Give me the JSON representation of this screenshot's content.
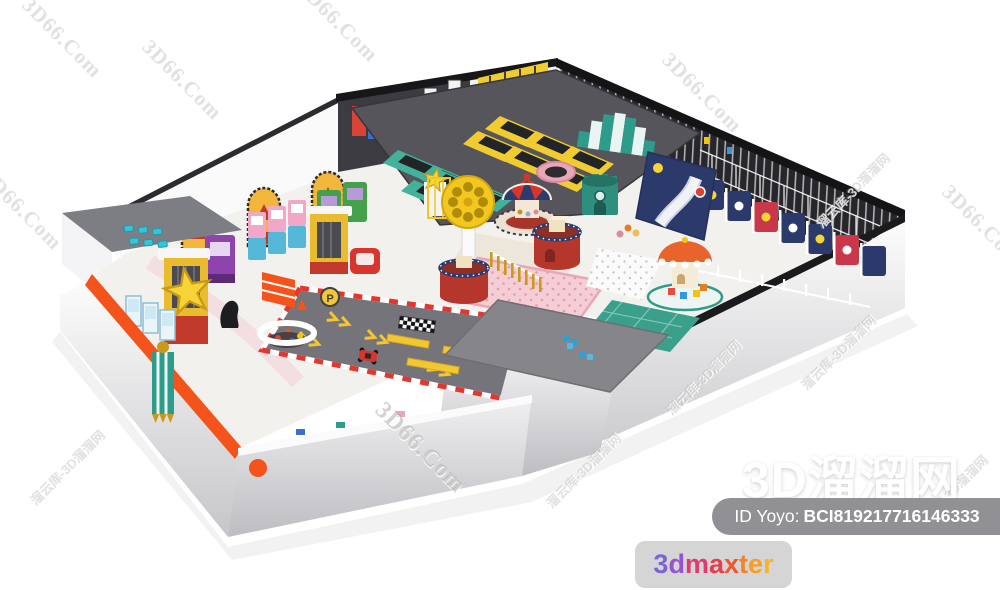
{
  "watermarks": {
    "en": "3D66.Com",
    "cn": "溜云库-3D溜溜网",
    "site": "3D溜溜网"
  },
  "id_badge": {
    "label": "ID Yoyo:",
    "value": "BCI819217716146333"
  },
  "brand": {
    "name": "3dmaxter",
    "letters": [
      "3",
      "d",
      "m",
      "a",
      "x",
      "t",
      "e",
      "r"
    ],
    "letter_colors": [
      "#7c64d8",
      "#9a50d2",
      "#e03a6e",
      "#e63c4b",
      "#ee5733",
      "#f48229",
      "#f79e26",
      "#f9b424"
    ]
  },
  "scene": {
    "parking_label": "P",
    "colors": {
      "orange_accent": "#f4531b",
      "play_yellow": "#f0cc30",
      "play_teal": "#2e9c8a",
      "play_navy": "#2b3a6a",
      "play_red": "#d8352c",
      "play_pink": "#f5cdd4",
      "track_gray": "#76767b",
      "dark_wall": "#2a2a2f"
    }
  },
  "ui": {
    "badge_bg": "#909095",
    "card_bg": "#d5d5d5"
  }
}
